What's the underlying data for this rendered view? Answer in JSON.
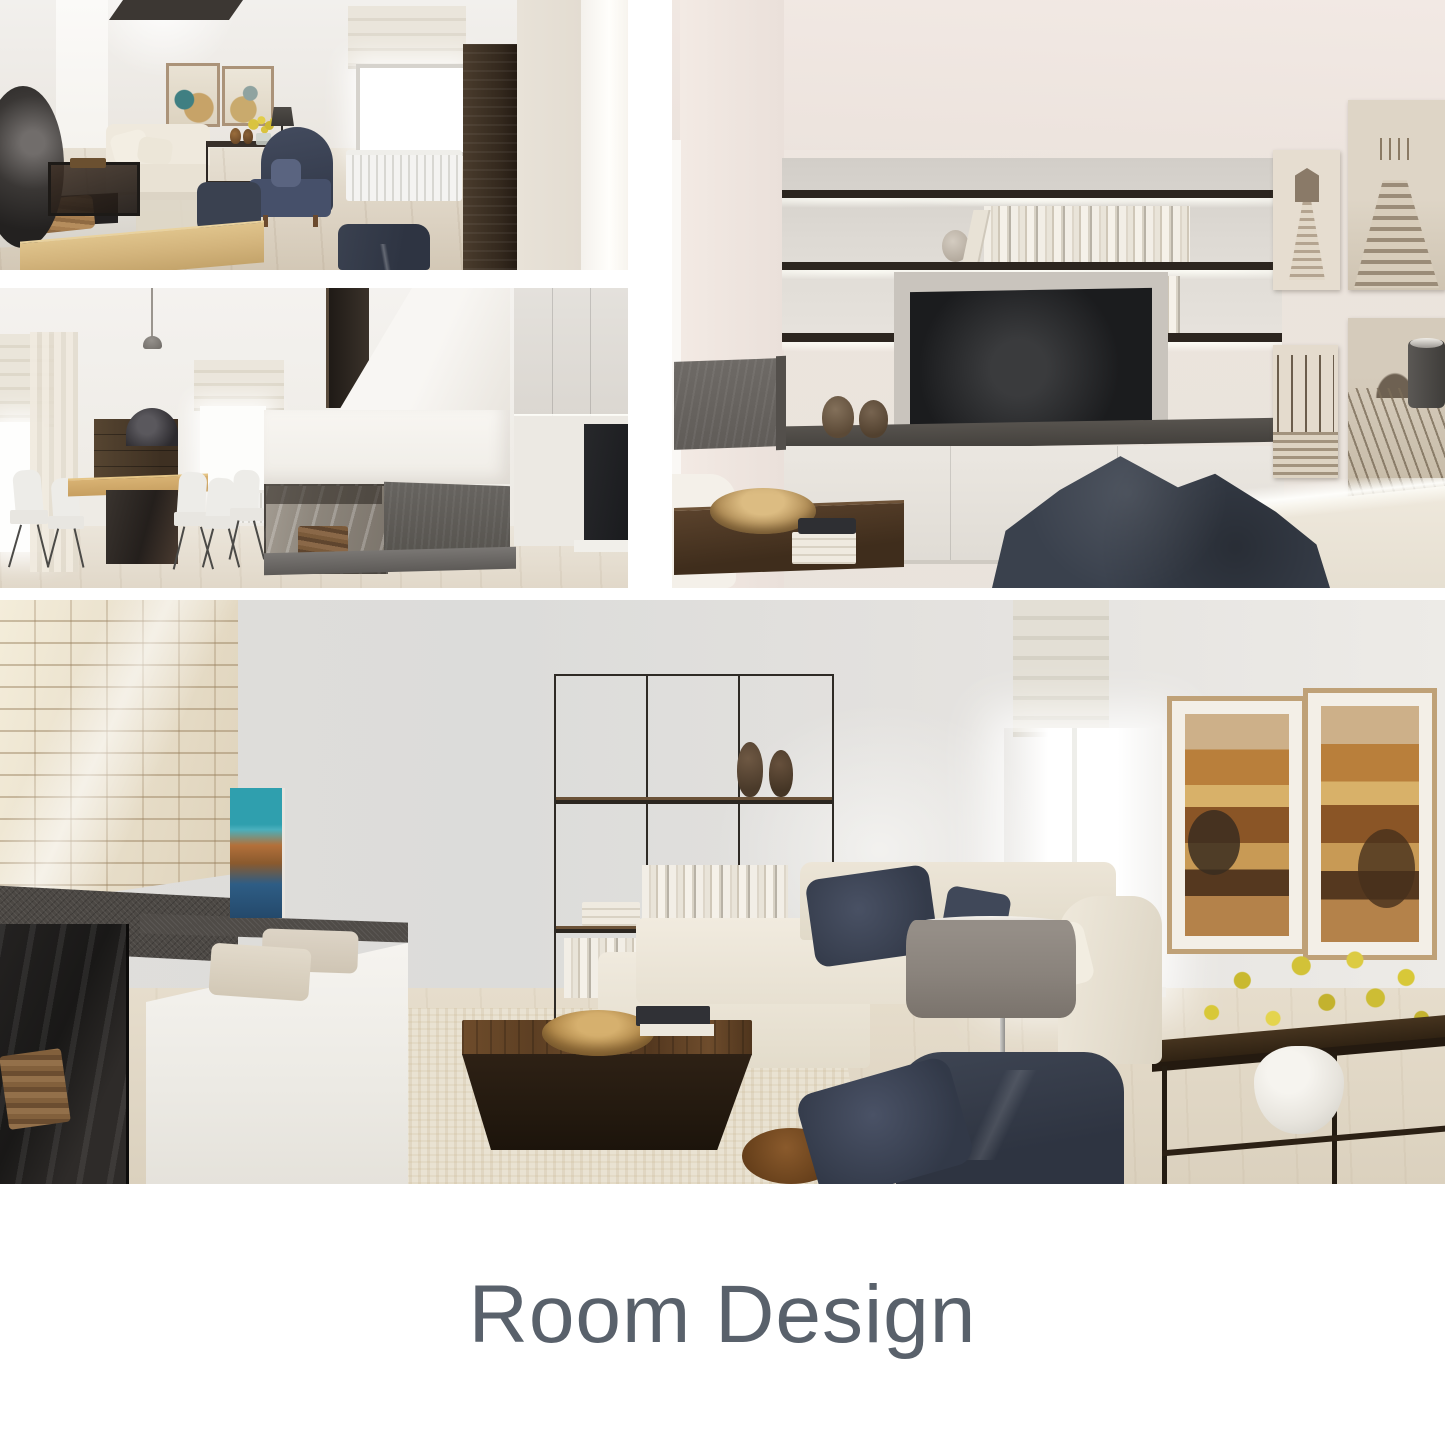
{
  "title": {
    "text": "Room Design",
    "color": "#59616b"
  },
  "collage": {
    "background": "#ffffff",
    "panels": [
      {
        "id": "living-room-fireplace-view",
        "alt": "Living room render with dark dome fireplace, cream sofa, navy wingback armchair, window and tall walnut cabinet"
      },
      {
        "id": "dining-area-view",
        "alt": "Dining area render with oak table, white chairs, wood sideboard and double-sided glass fireplace under white chimney"
      },
      {
        "id": "tv-wall-view",
        "alt": "Media wall render with lit floating shelves of books, wall TV over white cabinets, navy bean bag and sepia beach photographs"
      },
      {
        "id": "main-living-room-view",
        "alt": "Living room render with white stone fireplace, black grid wall shelf, walnut coffee table, white sectional sofa, navy armchair and rust abstract art"
      }
    ],
    "accent_colors": {
      "navy": "#3a414d",
      "cream": "#ece6da",
      "walnut": "#4a3525",
      "slate": "#5f5c59",
      "brass": "#b18849",
      "teal_art": "#2f9fae",
      "rust_art": "#b97f3b",
      "flower_yellow": "#d8c838"
    }
  }
}
